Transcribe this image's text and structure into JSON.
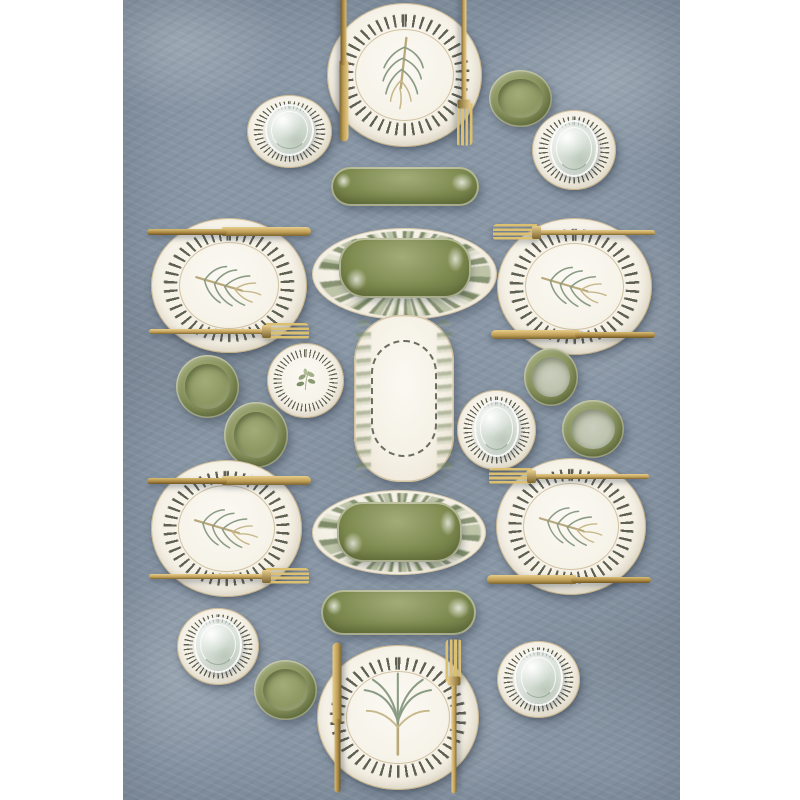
{
  "image_description": "Overhead product photograph of a gold-accented botanical dinnerware set arranged symmetrically on a mottled blue-gray linen backdrop; vertical photo centered on a white page with white margins left and right.",
  "scene": {
    "type": "product-photo",
    "subject": "dinnerware serving set with fir and palm motifs",
    "background": "blue-gray textured linen",
    "page_margins": "white"
  },
  "palette": {
    "page_bg": "#ffffff",
    "fabric": "#8997a6",
    "fabric_light": "#adb8c5",
    "fabric_dark": "#727e8b",
    "plate": "#f5f1e6",
    "plate_deep": "#e7e0cf",
    "dash": "#3e4132",
    "gold": "#c2a057",
    "gold_light": "#e7cd8c",
    "gold_dark": "#7c6530",
    "green": "#8a9560",
    "green_light": "#a2ac78",
    "green_dark": "#66713e",
    "green_pale": "#bcc3ae",
    "capsule": "#7d8b50",
    "motif_green": "#8b9c85",
    "motif_tan": "#c6b88a"
  },
  "labels": {
    "photo": "Gold-rimmed botanical dinnerware set on blue linen",
    "linen": "Blue-gray textured linen backdrop",
    "dinner_plate": "Round dinner plate with gold rope rim and fir sprig",
    "palm_plate": "Round dinner plate with palm frond motif",
    "serving_platter": "Oval serving platter with rope rim and fir sprig",
    "leaf_platter": "Oval platter with leaf-patterned rim",
    "green_dish": "Olive green serving dish",
    "oblong_tray": "Oblong tray with rope border and leaf edges",
    "capsule_tray": "Olive green oblong tray",
    "green_bowl": "Olive green bowl",
    "pale_bowl": "Olive green bowl with pale interior",
    "rope_plate": "Small plate with gold rope rim",
    "olive_plate": "Small plate with olive branch motif",
    "glass": "Clear drinking glass",
    "knife": "Gold knife",
    "fork": "Gold fork"
  },
  "item_counts": {
    "round_dinner_plates": 2,
    "oval_platters": 4,
    "leaf_rim_platters": 2,
    "green_inner_dishes": 2,
    "rope_oblong_tray": 1,
    "green_capsule_trays": 2,
    "green_bowls": 6,
    "small_rope_plates": 5,
    "olive_motif_plates": 1,
    "glasses": 5,
    "gold_knives": 6,
    "gold_forks": 6
  }
}
